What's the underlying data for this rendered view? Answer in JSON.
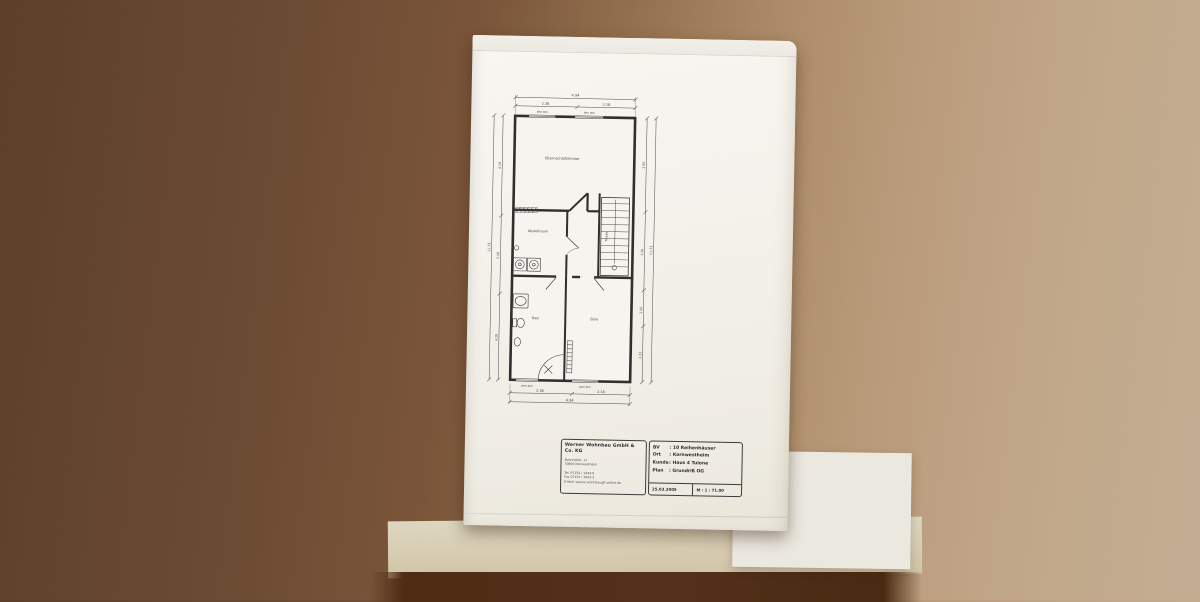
{
  "colors": {
    "paper": "#f3f1ea",
    "table_brown": "#6b4a33",
    "table_tan": "#c2a98c",
    "shelf_cream": "#d7cdb2",
    "floor_dark": "#4a2a12",
    "ink": "#3c3c3c"
  },
  "plan": {
    "rooms": {
      "bedroom": "Elternschlafzimmer",
      "storage": "Abstellraum",
      "bath": "Bad",
      "office": "Büro",
      "stairs": "Treppe"
    },
    "dims": {
      "width_total": "4.94",
      "width_left": "2.38",
      "width_right": "2.18",
      "height_total": "11.73",
      "left_segments": [
        "4.19",
        "3.26",
        "4.28"
      ],
      "right_segments": [
        "3.90",
        "3.26",
        "1.50",
        "2.33"
      ]
    },
    "window_label": "BRH 800"
  },
  "titleblock": {
    "company": {
      "name": "Werner Wohnbau GmbH & Co. KG",
      "address1": "Bahnhofstr. 11",
      "address2": "70806 Kornwestheim",
      "tel": "Tel. 07154 / 1443-0",
      "fax": "Fax 07154 / 1843-3",
      "email": "E-Mail: werner.wohnbau@t-online.de"
    },
    "project": {
      "separator": ":",
      "rows": [
        {
          "label": "BV",
          "value": "10 Reihenhäuser"
        },
        {
          "label": "Ort",
          "value": "Kornwestheim"
        },
        {
          "label": "Kunde",
          "value": "Haus 4 Tulone"
        },
        {
          "label": "Plan",
          "value": "Grundriß OG"
        }
      ],
      "date": "25.03.2005",
      "scale": "M : 1 : 71.00"
    }
  }
}
